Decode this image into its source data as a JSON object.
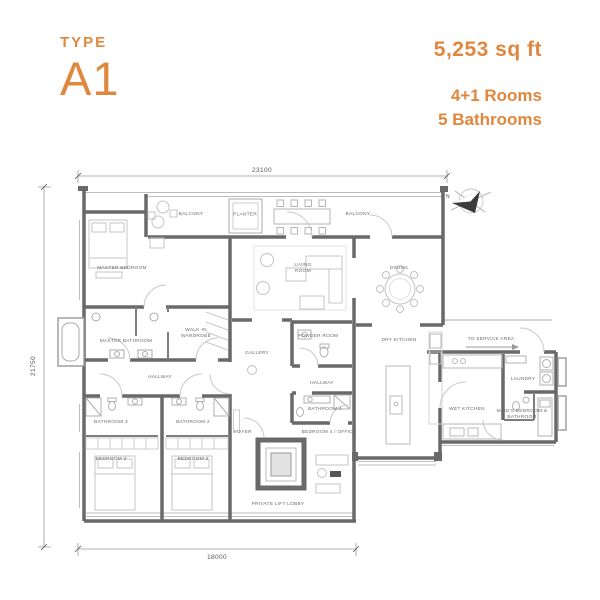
{
  "theme": {
    "accent": "#E0873E",
    "wall_color": "#696969"
  },
  "header": {
    "type_label": "TYPE",
    "type_value": "A1",
    "area": "5,253 sq ft",
    "rooms": "4+1 Rooms",
    "bathrooms": "5 Bathrooms"
  },
  "plan": {
    "dimensions": {
      "top": "23100",
      "left": "21750",
      "bottom": "18000"
    },
    "compass_label": "N",
    "rooms": [
      {
        "id": "master-bedroom",
        "label": "MASTER BEDROOM"
      },
      {
        "id": "balcony-left",
        "label": "BALCONY"
      },
      {
        "id": "planter",
        "label": "PLANTER"
      },
      {
        "id": "balcony-right",
        "label": "BALCONY"
      },
      {
        "id": "living-room",
        "label": "LIVING\nROOM"
      },
      {
        "id": "dining",
        "label": "DINING"
      },
      {
        "id": "master-bathroom",
        "label": "MASTER BATHROOM"
      },
      {
        "id": "walk-in-wardrobe",
        "label": "WALK-IN\nWARDROBE"
      },
      {
        "id": "hallway-1",
        "label": "HALLWAY"
      },
      {
        "id": "gallery",
        "label": "GALLERY"
      },
      {
        "id": "powder-room",
        "label": "POWDER ROOM"
      },
      {
        "id": "dry-kitchen",
        "label": "DRY KITCHEN"
      },
      {
        "id": "to-service-area",
        "label": "TO SERVICE AREA"
      },
      {
        "id": "laundry",
        "label": "LAUNDRY"
      },
      {
        "id": "wet-kitchen",
        "label": "WET KITCHEN"
      },
      {
        "id": "maids-room",
        "label": "MAID'S BEDROOM &\nBATHROOM"
      },
      {
        "id": "bathroom-3",
        "label": "BATHROOM 3"
      },
      {
        "id": "bathroom-2",
        "label": "BATHROOM 2"
      },
      {
        "id": "bedroom-3",
        "label": "BEDROOM 3"
      },
      {
        "id": "bedroom-2",
        "label": "BEDROOM 2"
      },
      {
        "id": "foyer",
        "label": "FOYER"
      },
      {
        "id": "hallway-2",
        "label": "HALLWAY"
      },
      {
        "id": "bathroom-4",
        "label": "BATHROOM 4"
      },
      {
        "id": "bedroom-4-office",
        "label": "BEDROOM 4 / OFFICE"
      },
      {
        "id": "private-lift-lobby",
        "label": "PRIVATE LIFT LOBBY"
      }
    ]
  }
}
